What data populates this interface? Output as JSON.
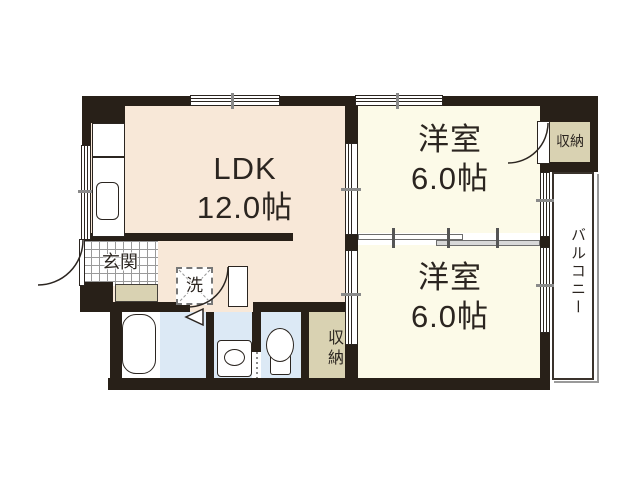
{
  "plan": {
    "title": "apartment-floor-plan",
    "rooms": {
      "ldk": {
        "label": "LDK",
        "size": "12.0帖"
      },
      "western_top": {
        "label": "洋室",
        "size": "6.0帖"
      },
      "western_bottom": {
        "label": "洋室",
        "size": "6.0帖"
      },
      "storage_top": {
        "label": "収納"
      },
      "storage_bottom": {
        "label": "収納"
      },
      "entrance": {
        "label": "玄関"
      },
      "laundry": {
        "label": "洗"
      },
      "balcony": {
        "label": "バルコニー"
      }
    },
    "colors": {
      "wall": "#282018",
      "ldk_floor": "#f8e8d8",
      "western_floor": "#fcfae8",
      "storage_floor": "#d9d2b2",
      "wet_area_floor": "#dce9f5",
      "balcony_floor": "#ffffff",
      "text": "#2b2520",
      "tile_grid": "#9a9a9a"
    }
  }
}
